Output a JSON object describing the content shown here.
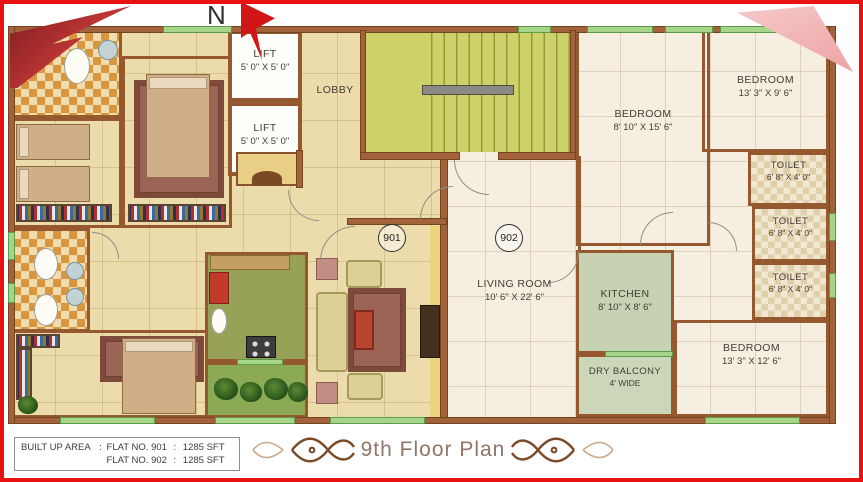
{
  "frame": {
    "north_label": "N"
  },
  "core": {
    "lifts": [
      {
        "name": "LIFT",
        "dims": "5' 0\" X 5' 0\""
      },
      {
        "name": "LIFT",
        "dims": "5' 0\" X 5' 0\""
      }
    ],
    "lobby": {
      "name": "LOBBY"
    }
  },
  "flat_901": {
    "number": "901"
  },
  "flat_902": {
    "number": "902",
    "living_room": {
      "name": "LIVING ROOM",
      "dims": "10' 6\" X 22' 6\""
    },
    "bedroom_top": {
      "name": "BEDROOM",
      "dims": "8' 10\" X 15' 6\""
    },
    "bedroom_right": {
      "name": "BEDROOM",
      "dims": "13' 3\" X 9' 6\""
    },
    "bedroom_bottom": {
      "name": "BEDROOM",
      "dims": "13' 3\" X 12' 6\""
    },
    "toilets": [
      {
        "name": "TOILET",
        "dims": "6' 8\" X 4' 0\""
      },
      {
        "name": "TOILET",
        "dims": "6' 8\" X 4' 0\""
      },
      {
        "name": "TOILET",
        "dims": "6' 8\" X 4' 0\""
      }
    ],
    "kitchen": {
      "name": "KITCHEN",
      "dims": "8' 10\" X 8' 6\""
    },
    "dry_balcony": {
      "name": "DRY BALCONY",
      "dims": "4' WIDE"
    }
  },
  "footer": {
    "built_up": {
      "label": "BUILT UP AREA",
      "rows": [
        {
          "sep": ":",
          "flat": "FLAT NO. 901",
          "sep2": ":",
          "area": "1285 SFT"
        },
        {
          "sep": "",
          "flat": "FLAT NO. 902",
          "sep2": ":",
          "area": "1285 SFT"
        }
      ]
    },
    "title": "9th Floor Plan"
  },
  "colors": {
    "frame_red": "#e81212",
    "wall_brown": "#a2633a",
    "stairs_green": "#ccd168",
    "window_green": "#a6d488",
    "kitchen_green": "#c6d2b2",
    "title_brown": "#8f7669"
  }
}
